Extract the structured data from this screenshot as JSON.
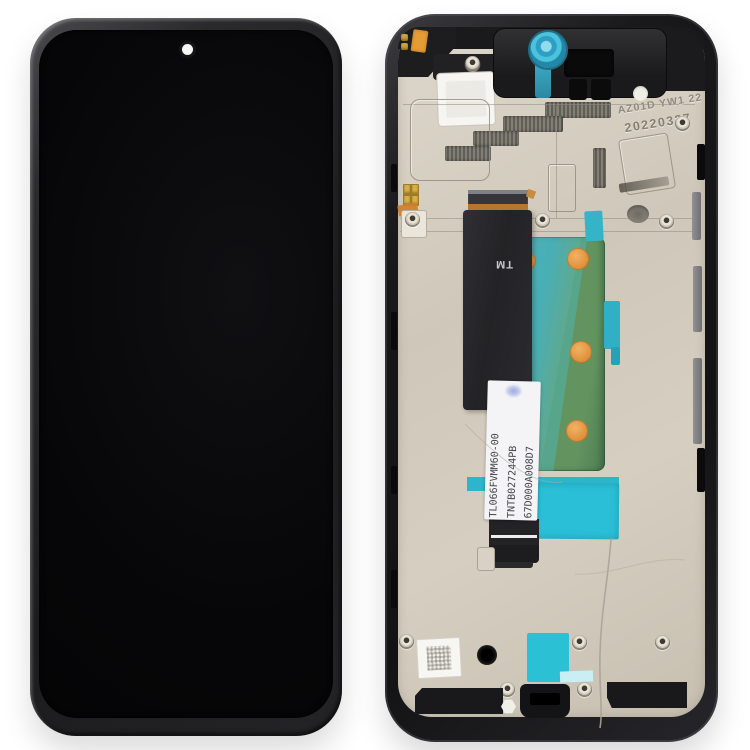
{
  "scene": {
    "description": "Product photo of a phone LCD screen and digitizer full assembly with frame: front display on the left, rear view of the middle frame with flex cable on the right",
    "background_color": "#ffffff"
  },
  "lcd_front": {
    "camera": "punch-hole front camera, top center"
  },
  "mid_frame": {
    "engraving": "AZ01D YW1 22",
    "date_code": "20220327",
    "flex": {
      "marking": "TM",
      "label_lines": [
        "TL066FVMM60-00",
        "TNTB027244PB",
        "67D000A008D7"
      ]
    }
  },
  "colors": {
    "screen_black": "#060608",
    "frame_metal_beige": "#cfc8ba",
    "plastic_black": "#1b1b1d",
    "teal_sticker": "#2cc0d5",
    "pcb_green": "#6e9c68",
    "orange_dot": "#de8f3a",
    "copper": "#b5772f",
    "gold_contact": "#d9b148",
    "label_white": "#f4f4f6"
  }
}
